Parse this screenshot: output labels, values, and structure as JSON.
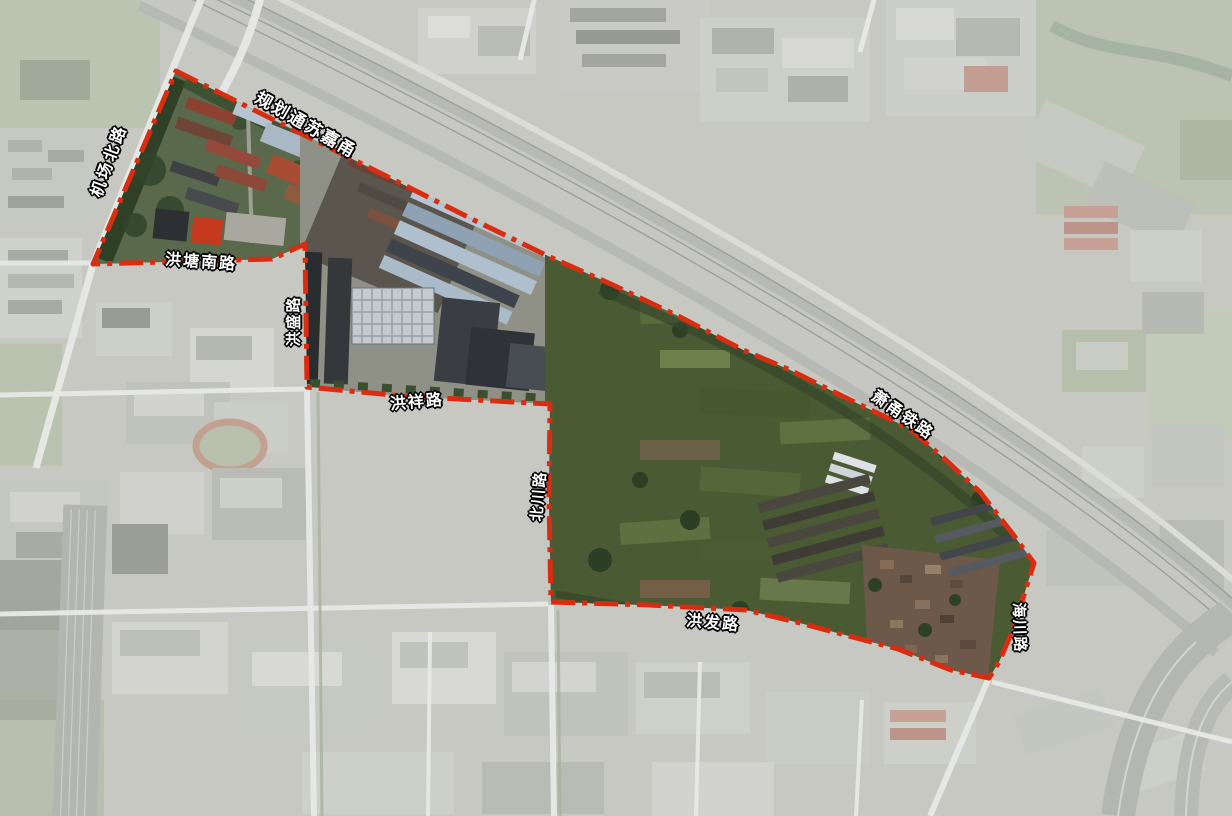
{
  "boundary": {
    "color": "#d92c10",
    "width": 5,
    "dash": "24 7 5 7",
    "style": "red dash-dot planning boundary",
    "points": [
      [
        176,
        71
      ],
      [
        380,
        173
      ],
      [
        480,
        223
      ],
      [
        550,
        257
      ],
      [
        613,
        285
      ],
      [
        680,
        317
      ],
      [
        743,
        350
      ],
      [
        790,
        370
      ],
      [
        840,
        395
      ],
      [
        910,
        429
      ],
      [
        948,
        462
      ],
      [
        980,
        492
      ],
      [
        1012,
        533
      ],
      [
        1034,
        563
      ],
      [
        1023,
        598
      ],
      [
        1012,
        632
      ],
      [
        999,
        662
      ],
      [
        989,
        678
      ],
      [
        951,
        670
      ],
      [
        898,
        649
      ],
      [
        800,
        623
      ],
      [
        746,
        610
      ],
      [
        649,
        605
      ],
      [
        551,
        602
      ],
      [
        549,
        500
      ],
      [
        550,
        404
      ],
      [
        403,
        396
      ],
      [
        307,
        387
      ],
      [
        305,
        244
      ],
      [
        272,
        259
      ],
      [
        93,
        264
      ]
    ]
  },
  "road_labels": [
    {
      "text": "机场北路",
      "x": 110,
      "y": 161,
      "rotate": -70,
      "size": 16,
      "spacing": 3
    },
    {
      "text": "规划通苏嘉甬",
      "x": 306,
      "y": 125,
      "rotate": 30,
      "size": 17,
      "spacing": 2
    },
    {
      "text": "洪塘南路",
      "x": 201,
      "y": 263,
      "rotate": 4,
      "size": 16,
      "spacing": 2
    },
    {
      "text": "洪盛路",
      "x": 294,
      "y": 321,
      "rotate": -90,
      "size": 15,
      "spacing": 2
    },
    {
      "text": "洪祥路",
      "x": 417,
      "y": 403,
      "rotate": -5,
      "size": 16,
      "spacing": 2
    },
    {
      "text": "北川路",
      "x": 539,
      "y": 496,
      "rotate": -85,
      "size": 15,
      "spacing": 2
    },
    {
      "text": "洪发路",
      "x": 713,
      "y": 624,
      "rotate": 5,
      "size": 16,
      "spacing": 2
    },
    {
      "text": "海川路",
      "x": 1019,
      "y": 628,
      "rotate": 88,
      "size": 15,
      "spacing": 2
    },
    {
      "text": "萧甬铁路",
      "x": 902,
      "y": 416,
      "rotate": 35,
      "size": 16,
      "spacing": 2
    }
  ],
  "palette": {
    "boundary_red": "#d92c10",
    "label_text": "#ffffff",
    "label_outline": "#000000",
    "washed_base": "#c7c8c2",
    "field_green": "#4a5a33",
    "warehouse_blue": "#a9bac9"
  }
}
